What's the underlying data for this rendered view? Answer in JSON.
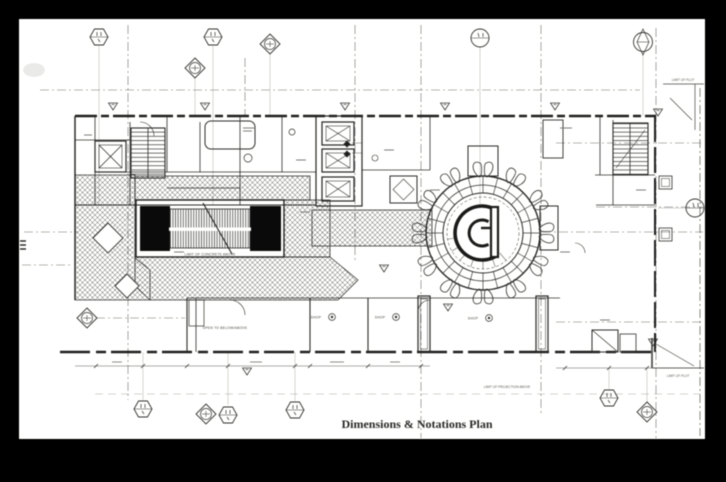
{
  "window": {
    "width": 726,
    "height": 482
  },
  "sheet": {
    "background": "#000000",
    "paper_color": "#fbfbf9"
  },
  "colors": {
    "line_dark": "#262626",
    "line_mid": "#555555",
    "line_light": "#8a8a8a"
  },
  "caption": {
    "text": "Dimensions & Notations Plan"
  },
  "labels": {
    "limit_of_plot_top": "LIMIT OF PLOT",
    "limit_of_plot_bottom": "LIMIT OF PLOT",
    "limit_of_projection_above": "LIMIT OF PROJECTION ABOVE",
    "limit_of_concrete_above": "LIMIT OF CONCRETE ABOVE",
    "open_to_below_above": "OPEN TO BELOW/ABOVE",
    "shop_1": "SHOP",
    "shop_2": "SHOP",
    "shop_3": "SHOP"
  }
}
